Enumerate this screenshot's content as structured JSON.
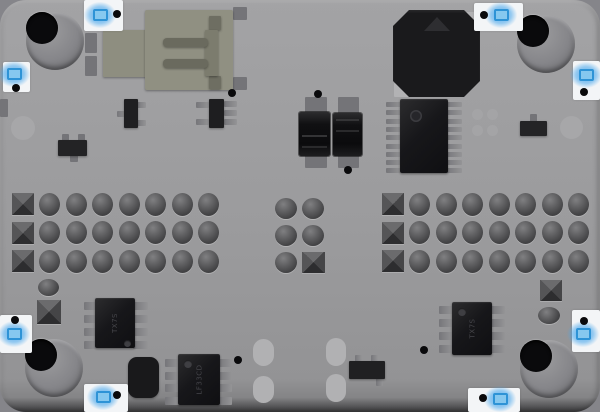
{
  "board": {
    "type": "pcb-top-view-render",
    "base_color": "#9b9b9d",
    "edge_shadow_color": "#333335",
    "marker_box_color": "#f3f5f7",
    "marker_blue_color": "#48a6eb",
    "chip_body_color": "#17171a",
    "pad_dark_color": "#747478",
    "pad_light_color": "#b2b2b4",
    "pin_color": "#8a8a8c"
  },
  "shapes": [
    {
      "name": "via-ring-left-edge",
      "kind": "circle",
      "cx": 23,
      "cy": 128,
      "d": 24,
      "fill": "#a7a7a9"
    },
    {
      "name": "via-ring-right-edge",
      "kind": "circle",
      "cx": 571,
      "cy": 127,
      "d": 23,
      "fill": "#a7a7a9"
    },
    {
      "name": "edge-pad-left",
      "kind": "pad",
      "x": 0,
      "y": 99,
      "w": 8,
      "h": 18,
      "c": "dark"
    },
    {
      "name": "mount-hole-top-left",
      "kind": "hole",
      "cx": 55,
      "cy": 41
    },
    {
      "name": "mount-hole-top-right",
      "kind": "hole",
      "cx": 546,
      "cy": 44
    },
    {
      "name": "mount-hole-bottom-left",
      "kind": "hole",
      "cx": 54,
      "cy": 368
    },
    {
      "name": "mount-hole-bottom-right",
      "kind": "hole",
      "cx": 549,
      "cy": 369
    },
    {
      "name": "usb-shield-pad",
      "kind": "pad",
      "x": 85,
      "y": 33,
      "w": 12,
      "h": 20,
      "c": "dark"
    },
    {
      "name": "usb-shield-pad",
      "kind": "pad",
      "x": 85,
      "y": 56,
      "w": 12,
      "h": 20,
      "c": "dark"
    },
    {
      "name": "usb-shield-pad",
      "kind": "pad",
      "x": 233,
      "y": 7,
      "w": 14,
      "h": 13,
      "c": "dark"
    },
    {
      "name": "usb-shield-pad",
      "kind": "pad",
      "x": 233,
      "y": 77,
      "w": 14,
      "h": 13,
      "c": "dark"
    },
    {
      "name": "usb-connector-tab",
      "kind": "rect",
      "x": 103,
      "y": 30,
      "w": 44,
      "h": 47,
      "fill": "#8e8e80",
      "r": 1
    },
    {
      "name": "usb-connector-body",
      "kind": "rect",
      "x": 145,
      "y": 10,
      "w": 88,
      "h": 80,
      "fill": "#909082",
      "r": 2,
      "i": true
    },
    {
      "name": "usb-prong",
      "kind": "rect",
      "x": 209,
      "y": 16,
      "w": 12,
      "h": 14,
      "fill": "#6e6e62",
      "r": 1
    },
    {
      "name": "usb-prong",
      "kind": "rect",
      "x": 209,
      "y": 76,
      "w": 12,
      "h": 13,
      "fill": "#6e6e62",
      "r": 1
    },
    {
      "name": "usb-tongue-edge",
      "kind": "rect",
      "x": 205,
      "y": 30,
      "w": 13,
      "h": 46,
      "fill": "#7c7c6e",
      "r": 1
    },
    {
      "name": "usb-contact",
      "kind": "rect",
      "x": 163,
      "y": 38,
      "w": 45,
      "h": 9,
      "fill": "#6a6a5e",
      "r": 4
    },
    {
      "name": "usb-contact",
      "kind": "rect",
      "x": 163,
      "y": 59,
      "w": 45,
      "h": 9,
      "fill": "#6a6a5e",
      "r": 4
    },
    {
      "name": "buzzer-corner-pad",
      "kind": "pad",
      "x": 466,
      "y": 12,
      "w": 15,
      "h": 15,
      "c": "light"
    },
    {
      "name": "buzzer-corner-pad",
      "kind": "pad",
      "x": 394,
      "y": 83,
      "w": 15,
      "h": 14,
      "c": "light"
    },
    {
      "name": "buzzer",
      "kind": "oct",
      "x": 393,
      "y": 10,
      "w": 87,
      "h": 87,
      "i": true
    },
    {
      "name": "tssop-pin-row-left",
      "kind": "pinrow",
      "x": 386,
      "y0": 102,
      "n": 9,
      "pitch": 8.3,
      "w": 16,
      "h": 5
    },
    {
      "name": "tssop-pin-row-right",
      "kind": "pinrow",
      "x": 446,
      "y0": 102,
      "n": 9,
      "pitch": 8.3,
      "w": 16,
      "h": 5
    },
    {
      "name": "tssop-ic",
      "kind": "chip",
      "x": 400,
      "y": 99,
      "w": 48,
      "h": 74,
      "dot": {
        "dx": 10,
        "dy": 11,
        "d": 12
      },
      "i": true
    },
    {
      "name": "via",
      "kind": "circle",
      "cx": 477,
      "cy": 114,
      "d": 11,
      "fill": "#a4a4a6"
    },
    {
      "name": "via",
      "kind": "circle",
      "cx": 492,
      "cy": 114,
      "d": 11,
      "fill": "#a4a4a6"
    },
    {
      "name": "via",
      "kind": "circle",
      "cx": 477,
      "cy": 130,
      "d": 11,
      "fill": "#a4a4a6"
    },
    {
      "name": "via",
      "kind": "circle",
      "cx": 492,
      "cy": 130,
      "d": 11,
      "fill": "#a4a4a6"
    },
    {
      "name": "resistor-tab",
      "kind": "pad",
      "x": 530,
      "y": 114,
      "w": 7,
      "h": 8,
      "c": "dark"
    },
    {
      "name": "smd-resistor-right",
      "kind": "rect",
      "x": 520,
      "y": 121,
      "w": 27,
      "h": 15,
      "fill": "#242426",
      "r": 1,
      "i": true
    },
    {
      "name": "resistor-tab",
      "kind": "pad",
      "x": 62,
      "y": 134,
      "w": 7,
      "h": 7,
      "c": "dark"
    },
    {
      "name": "resistor-tab",
      "kind": "pad",
      "x": 78,
      "y": 134,
      "w": 7,
      "h": 7,
      "c": "dark"
    },
    {
      "name": "resistor-tab",
      "kind": "pad",
      "x": 70,
      "y": 155,
      "w": 8,
      "h": 7,
      "c": "dark"
    },
    {
      "name": "smd-resistor-left",
      "kind": "rect",
      "x": 58,
      "y": 140,
      "w": 29,
      "h": 16,
      "fill": "#232325",
      "r": 1,
      "i": true
    },
    {
      "name": "sot23-pad",
      "kind": "pad",
      "x": 117,
      "y": 111,
      "w": 9,
      "h": 6,
      "c": "pin"
    },
    {
      "name": "sot23-pad",
      "kind": "pad",
      "x": 137,
      "y": 102,
      "w": 9,
      "h": 6,
      "c": "pin"
    },
    {
      "name": "sot23-pad",
      "kind": "pad",
      "x": 137,
      "y": 120,
      "w": 9,
      "h": 6,
      "c": "pin"
    },
    {
      "name": "sot23-transistor",
      "kind": "rect",
      "x": 124,
      "y": 99,
      "w": 14,
      "h": 29,
      "fill": "#1f1f21",
      "r": 1,
      "i": true
    },
    {
      "name": "sot23-6-pad",
      "kind": "pad",
      "x": 196,
      "y": 102,
      "w": 13,
      "h": 6,
      "c": "pin"
    },
    {
      "name": "sot23-6-pad",
      "kind": "pad",
      "x": 196,
      "y": 119,
      "w": 13,
      "h": 6,
      "c": "pin"
    },
    {
      "name": "sot23-6-pad",
      "kind": "pad",
      "x": 224,
      "y": 101,
      "w": 13,
      "h": 6,
      "c": "pin"
    },
    {
      "name": "sot23-6-pad",
      "kind": "pad",
      "x": 224,
      "y": 110,
      "w": 13,
      "h": 6,
      "c": "pin"
    },
    {
      "name": "sot23-6-pad",
      "kind": "pad",
      "x": 224,
      "y": 119,
      "w": 13,
      "h": 6,
      "c": "pin"
    },
    {
      "name": "sot23-6-ic",
      "kind": "rect",
      "x": 209,
      "y": 99,
      "w": 15,
      "h": 29,
      "fill": "#1e1e20",
      "r": 1,
      "i": true
    },
    {
      "name": "capacitor-pad",
      "kind": "pad",
      "x": 305,
      "y": 97,
      "w": 22,
      "h": 17,
      "c": "dark"
    },
    {
      "name": "capacitor-pad",
      "kind": "pad",
      "x": 305,
      "y": 151,
      "w": 22,
      "h": 17,
      "c": "dark"
    },
    {
      "name": "capacitor-left",
      "kind": "cap",
      "x": 299,
      "y": 112,
      "w": 31,
      "h": 44,
      "stripes": "bottom",
      "i": true
    },
    {
      "name": "capacitor-pad",
      "kind": "pad",
      "x": 338,
      "y": 97,
      "w": 21,
      "h": 17,
      "c": "dark"
    },
    {
      "name": "capacitor-pad",
      "kind": "pad",
      "x": 338,
      "y": 151,
      "w": 21,
      "h": 17,
      "c": "dark"
    },
    {
      "name": "capacitor-right",
      "kind": "cap",
      "x": 333,
      "y": 113,
      "w": 29,
      "h": 43,
      "stripes": "top",
      "i": true
    },
    {
      "name": "header-left",
      "kind": "header",
      "x0": 23,
      "y0": 204,
      "dx": 26.57,
      "dy": 28.5,
      "cols": 8,
      "rows": 3
    },
    {
      "name": "header-right",
      "kind": "header",
      "x0": 393,
      "y0": 204,
      "dx": 26.57,
      "dy": 28.5,
      "cols": 8,
      "rows": 3
    },
    {
      "name": "pad-dome",
      "kind": "dome",
      "cx": 286,
      "cy": 208,
      "w": 22,
      "h": 21
    },
    {
      "name": "pad-dome",
      "kind": "dome",
      "cx": 313,
      "cy": 208,
      "w": 22,
      "h": 21
    },
    {
      "name": "pad-dome",
      "kind": "dome",
      "cx": 286,
      "cy": 235,
      "w": 22,
      "h": 21
    },
    {
      "name": "pad-dome",
      "kind": "dome",
      "cx": 313,
      "cy": 235,
      "w": 22,
      "h": 21
    },
    {
      "name": "pad-dome",
      "kind": "dome",
      "cx": 286,
      "cy": 262,
      "w": 22,
      "h": 21
    },
    {
      "name": "pad-square",
      "kind": "sq",
      "cx": 313,
      "cy": 262,
      "w": 23,
      "h": 21
    },
    {
      "name": "pad-dome",
      "kind": "dome",
      "cx": 48,
      "cy": 287,
      "w": 21,
      "h": 17
    },
    {
      "name": "pad-square",
      "kind": "sq",
      "cx": 49,
      "cy": 312,
      "w": 24,
      "h": 24
    },
    {
      "name": "pad-square",
      "kind": "sq",
      "cx": 551,
      "cy": 290,
      "w": 22,
      "h": 21
    },
    {
      "name": "pad-dome",
      "kind": "dome",
      "cx": 549,
      "cy": 315,
      "w": 22,
      "h": 17
    },
    {
      "name": "soic8-pin-row",
      "kind": "pinrow",
      "x": 84,
      "y0": 302,
      "n": 4,
      "pitch": 13,
      "w": 13,
      "h": 8
    },
    {
      "name": "soic8-pin-row",
      "kind": "pinrow",
      "x": 133,
      "y0": 302,
      "n": 4,
      "pitch": 13,
      "w": 15,
      "h": 8
    },
    {
      "name": "soic8-ic-left",
      "kind": "chip",
      "x": 95,
      "y": 298,
      "w": 40,
      "h": 50,
      "dot": {
        "dx": 29,
        "dy": 42,
        "d": 7,
        "light": true
      },
      "marking": "TX7S",
      "i": true
    },
    {
      "name": "soic8-pin-row",
      "kind": "pinrow",
      "x": 165,
      "y0": 359,
      "n": 4,
      "pitch": 12.6,
      "w": 14,
      "h": 8
    },
    {
      "name": "soic8-pin-row",
      "kind": "pinrow",
      "x": 218,
      "y0": 359,
      "n": 4,
      "pitch": 12.6,
      "w": 14,
      "h": 8
    },
    {
      "name": "soic8-ic-bottom",
      "kind": "chip",
      "x": 178,
      "y": 354,
      "w": 42,
      "h": 51,
      "dot": {
        "dx": 6,
        "dy": 6,
        "d": 8,
        "light": true
      },
      "marking": "LF33CD",
      "i": true
    },
    {
      "name": "soic8-pin-row",
      "kind": "pinrow",
      "x": 439,
      "y0": 306,
      "n": 4,
      "pitch": 13,
      "w": 14,
      "h": 8
    },
    {
      "name": "soic8-pin-row",
      "kind": "pinrow",
      "x": 491,
      "y0": 306,
      "n": 4,
      "pitch": 13,
      "w": 14,
      "h": 8
    },
    {
      "name": "soic8-ic-right",
      "kind": "chip",
      "x": 452,
      "y": 302,
      "w": 40,
      "h": 53,
      "dot": {
        "dx": 6,
        "dy": 6,
        "d": 8,
        "light": true
      },
      "marking": "TX7S",
      "i": true
    },
    {
      "name": "crystal-component",
      "kind": "rect",
      "x": 128,
      "y": 357,
      "w": 31,
      "h": 41,
      "fill": "#19191b",
      "r": 9,
      "i": true
    },
    {
      "name": "sot23-pad",
      "kind": "pad",
      "x": 355,
      "y": 355,
      "w": 7,
      "h": 8,
      "c": "pin"
    },
    {
      "name": "sot23-pad",
      "kind": "pad",
      "x": 371,
      "y": 355,
      "w": 7,
      "h": 8,
      "c": "pin"
    },
    {
      "name": "sot23-pad",
      "kind": "pad",
      "x": 376,
      "y": 378,
      "w": 7,
      "h": 8,
      "c": "pin"
    },
    {
      "name": "sot23-bottom",
      "kind": "rect",
      "x": 349,
      "y": 361,
      "w": 36,
      "h": 18,
      "fill": "#202022",
      "r": 1,
      "i": true
    },
    {
      "name": "oval-pad",
      "kind": "capsule",
      "x": 253,
      "y": 339,
      "w": 21,
      "h": 27
    },
    {
      "name": "oval-pad",
      "kind": "capsule",
      "x": 253,
      "y": 376,
      "w": 21,
      "h": 27
    },
    {
      "name": "oval-pad",
      "kind": "capsule",
      "x": 326,
      "y": 338,
      "w": 20,
      "h": 28
    },
    {
      "name": "oval-pad",
      "kind": "capsule",
      "x": 326,
      "y": 374,
      "w": 20,
      "h": 28
    },
    {
      "name": "test-point",
      "kind": "dot",
      "cx": 232,
      "cy": 93
    },
    {
      "name": "test-point",
      "kind": "dot",
      "cx": 318,
      "cy": 94
    },
    {
      "name": "test-point",
      "kind": "dot",
      "cx": 348,
      "cy": 170
    },
    {
      "name": "test-point",
      "kind": "dot",
      "cx": 238,
      "cy": 360
    },
    {
      "name": "test-point",
      "kind": "dot",
      "cx": 424,
      "cy": 350
    },
    {
      "name": "marker-top",
      "kind": "marker",
      "x": 84,
      "y": 0,
      "w": 39,
      "h": 31,
      "blob": {
        "cx": 100,
        "cy": 15
      },
      "dot": {
        "cx": 117,
        "cy": 14
      }
    },
    {
      "name": "marker-top-right",
      "kind": "marker",
      "x": 474,
      "y": 3,
      "w": 49,
      "h": 28,
      "blob": {
        "cx": 501,
        "cy": 15
      },
      "dot": {
        "cx": 484,
        "cy": 15
      }
    },
    {
      "name": "marker-left-upper",
      "kind": "marker",
      "x": 3,
      "y": 62,
      "w": 27,
      "h": 30,
      "blob": {
        "cx": 14,
        "cy": 74
      },
      "dot": {
        "cx": 16,
        "cy": 88
      }
    },
    {
      "name": "marker-right-upper",
      "kind": "marker",
      "x": 573,
      "y": 61,
      "w": 27,
      "h": 39,
      "blob": {
        "cx": 586,
        "cy": 75
      },
      "dot": {
        "cx": 584,
        "cy": 92
      }
    },
    {
      "name": "marker-left-lower",
      "kind": "marker",
      "x": 0,
      "y": 315,
      "w": 32,
      "h": 38,
      "blob": {
        "cx": 14,
        "cy": 334
      },
      "dot": {
        "cx": 15,
        "cy": 320
      }
    },
    {
      "name": "marker-right-lower",
      "kind": "marker",
      "x": 572,
      "y": 310,
      "w": 28,
      "h": 42,
      "blob": {
        "cx": 583,
        "cy": 334
      },
      "dot": {
        "cx": 584,
        "cy": 321
      }
    },
    {
      "name": "marker-bottom-left",
      "kind": "marker",
      "x": 84,
      "y": 384,
      "w": 44,
      "h": 28,
      "blob": {
        "cx": 103,
        "cy": 397
      },
      "dot": {
        "cx": 117,
        "cy": 395
      }
    },
    {
      "name": "marker-bottom-right",
      "kind": "marker",
      "x": 468,
      "y": 388,
      "w": 52,
      "h": 24,
      "blob": {
        "cx": 500,
        "cy": 399
      },
      "dot": {
        "cx": 483,
        "cy": 398
      }
    }
  ]
}
